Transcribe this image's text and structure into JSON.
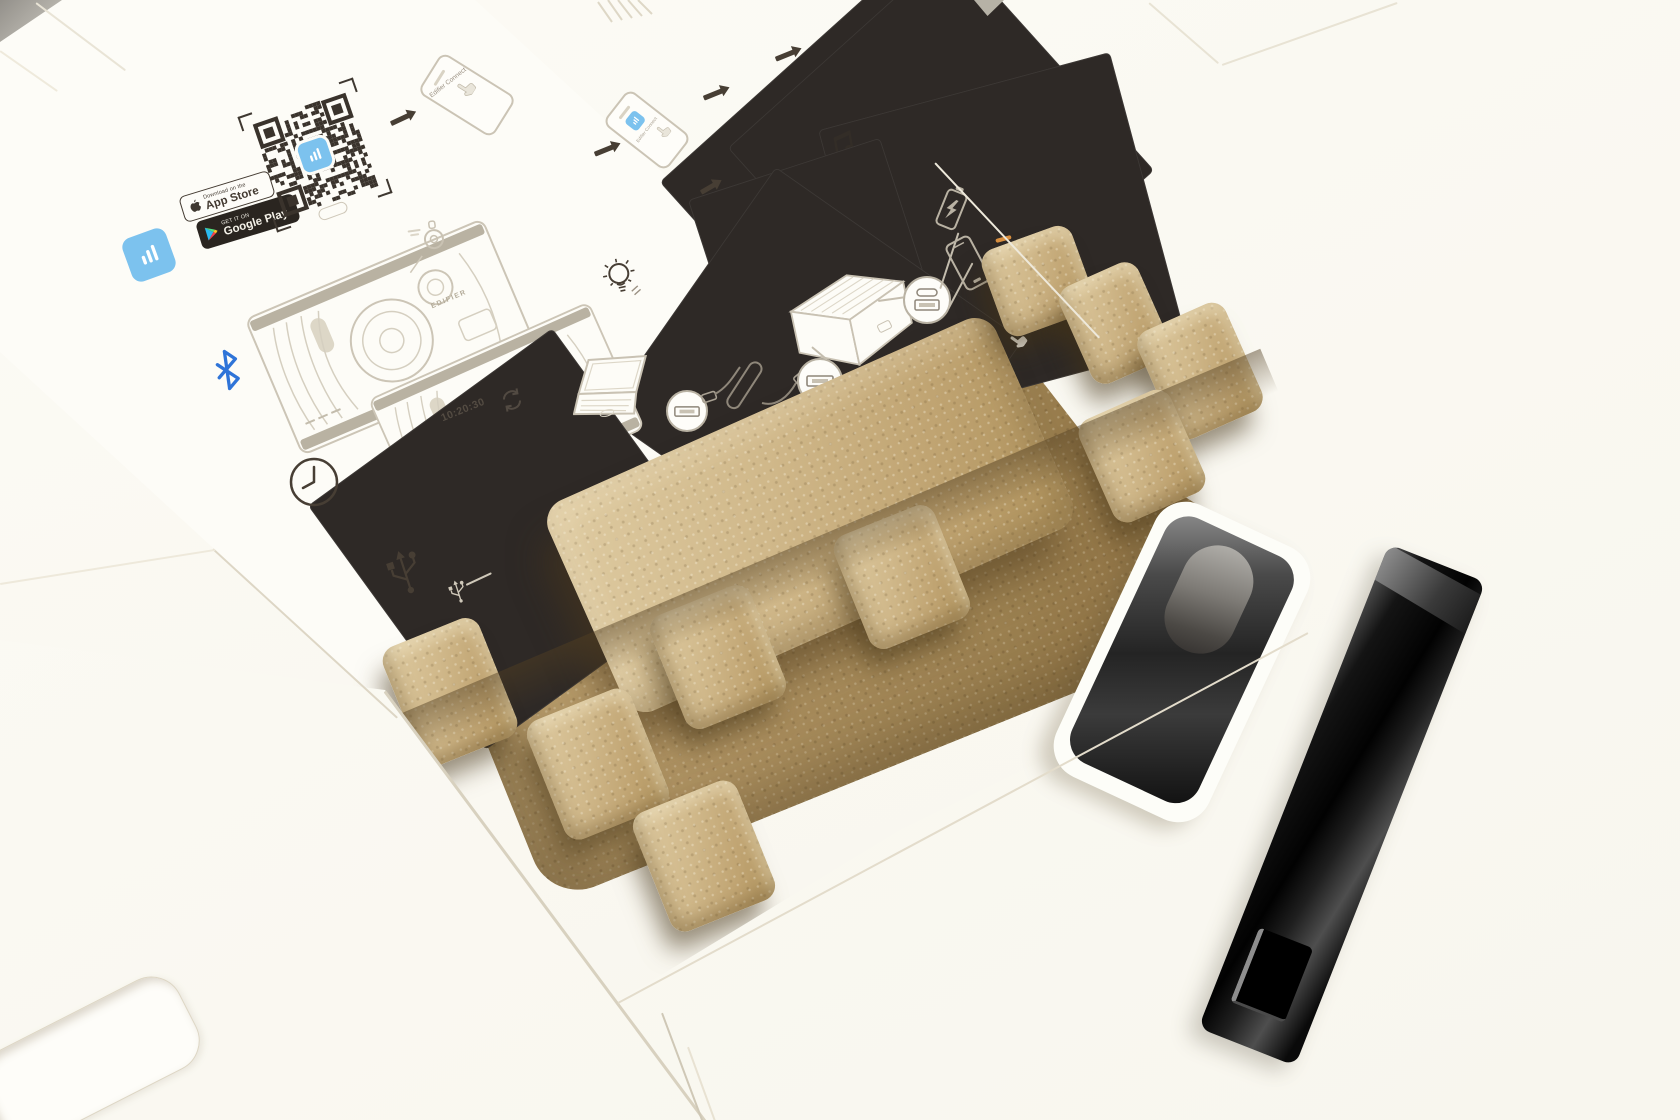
{
  "scene": {
    "description": "Opened Edifier speaker packaging: quick start guide printed inside the lid, molded pulp tray with raised bumps, glossy black insert and black plastic handle on white cardboard",
    "colors": {
      "background": "#faf9f2",
      "sheet_white": "#fdfcf7",
      "pulp_light": "#ddc99f",
      "pulp_mid": "#c0a472",
      "pulp_shadow": "#6f5937",
      "print_ink": "#3f3831",
      "line_art": "#c9c2b3",
      "app_blue": "#7cc2ee",
      "bluetooth_blue": "#2f74d8",
      "highlight_orange": "#d98f3f",
      "plastic_black": "#121212"
    }
  },
  "guide": {
    "app_store_badge": {
      "line1": "Download on the",
      "line2": "App Store"
    },
    "google_play_badge": {
      "line1": "GET IT ON",
      "line2": "Google Play"
    },
    "app_name": "Edifier Connect",
    "timer": "10:20:30",
    "brand": "EDIFIER",
    "led_palette": [
      "#e85fb0",
      "#b05cf0",
      "#58d89a",
      "#f2e04a",
      "#48c4e8",
      "#f06a52",
      "#8a7af0",
      "#ff9e3d"
    ]
  }
}
